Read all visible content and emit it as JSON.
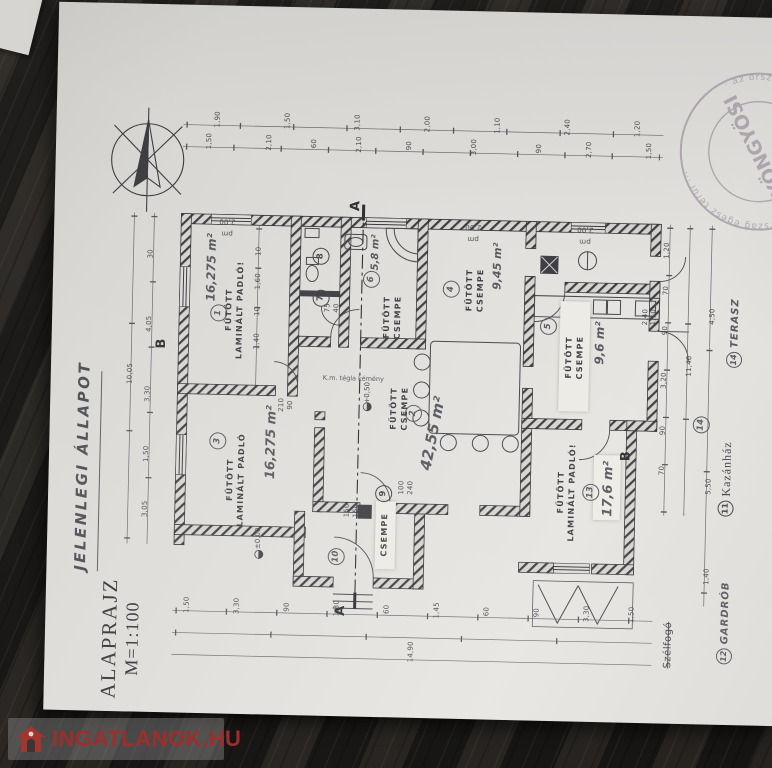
{
  "titles": {
    "status": "JELENLEGI ÁLLAPOT",
    "drawing": "ALAPRAJZ",
    "scale": "M=1:100"
  },
  "watermark": {
    "text": "INGATLANOK.HU"
  },
  "stamp": {
    "center": "GYÖNGYÖSI",
    "ring": "· az ország egész terül ··· ségi tervül ··· az ország egész terül ···"
  },
  "rooms": {
    "r1": {
      "num": "1",
      "label1": "FŰTÖTT",
      "label2": "LAMINÁLT PADLÓ!",
      "area": "16,275 m²"
    },
    "r2": {
      "num": "2",
      "label1": "FŰTÖTT",
      "label2": "CSEMPE",
      "area": "42,55 m²"
    },
    "r3": {
      "num": "3",
      "label1": "FŰTÖTT",
      "label2": "LAMINÁLT PADLÓ",
      "area": "16,275 m²"
    },
    "r4": {
      "num": "4",
      "label1": "FŰTÖTT",
      "label2": "CSEMPE",
      "area": "9,45 m²"
    },
    "r5": {
      "num": "5",
      "label1": "FŰTÖTT",
      "label2": "CSEMPE",
      "area": "9,6 m²"
    },
    "r6": {
      "num": "6",
      "label1": "FŰTÖTT",
      "label2": "CSEMPE",
      "area": "5,8 m²"
    },
    "r7": {
      "num": "7"
    },
    "r8": {
      "num": "8"
    },
    "r9": {
      "num": "9"
    },
    "r10": {
      "num": "10",
      "label1": "CSEMPE"
    },
    "r13": {
      "num": "13",
      "label1": "FŰTÖTT",
      "label2": "LAMINÁLT PADLÓ!",
      "area": "17,6 m²"
    },
    "r14": {
      "num": "14"
    }
  },
  "legend": {
    "terasz": {
      "num": "14",
      "label": "TERASZ"
    },
    "kazanhaz": {
      "num": "11",
      "label": "Kazánház"
    },
    "gardrob": {
      "num": "12",
      "label": "GARDRÓB"
    },
    "struck": "Szélfogó"
  },
  "levels": {
    "zero": "±0,00",
    "plus": "+0,50"
  },
  "marks": {
    "a": "A",
    "b": "B"
  },
  "notes": {
    "chimney": "K.m. tégla kémény"
  },
  "dims": {
    "top1": [
      "1,50",
      "2,10",
      "60",
      "2,10",
      "90",
      "3,00",
      "90",
      "2,70",
      "1,50"
    ],
    "top2": [
      "1,90",
      "1,50",
      "3,10",
      "2,00",
      "1,10",
      "2,40",
      "1,20"
    ],
    "left": [
      "30",
      "4,05",
      "3,30",
      "1,50",
      "3,05"
    ],
    "left_total": "10,05",
    "bottom": [
      "1,50",
      "3,30",
      "90",
      "1,30",
      "60",
      "1,45",
      "60",
      "90",
      "3,30",
      "1,50"
    ],
    "bottom_total": "14,90",
    "right": [
      "1,20",
      "70",
      "90",
      "3,20",
      "90",
      "70"
    ],
    "right_total": "11,40",
    "far_right": [
      "4,50",
      "5,50",
      "1,40"
    ],
    "interior": [
      "10",
      "1,60",
      "10",
      "1,40"
    ],
    "win_top": [
      "pm 2,00",
      "pm 2,00",
      "pm 2,00"
    ],
    "d150a": "150",
    "d150b": "150",
    "d100": "100",
    "d240": "240",
    "d210": "210",
    "d90": "90",
    "d75": "75",
    "d40": "40",
    "d110": "1,10",
    "d240b": "2,40"
  }
}
